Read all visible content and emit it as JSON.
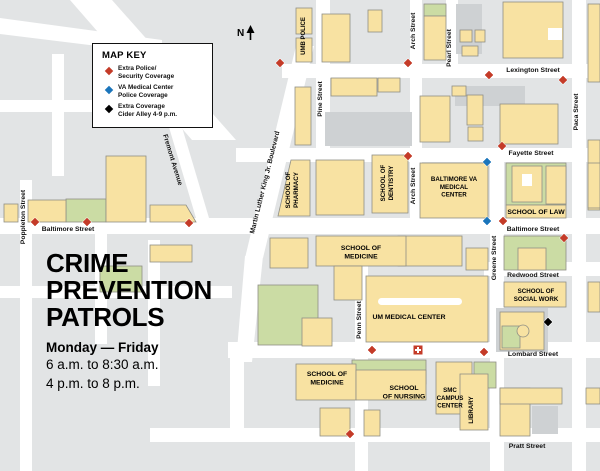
{
  "title_block": {
    "lines": [
      "CRIME",
      "PREVENTION",
      "PATROLS"
    ],
    "schedule_bold": "Monday — Friday",
    "schedule_lines": [
      "6 a.m. to 8:30 a.m.",
      "4 p.m. to 8 p.m."
    ]
  },
  "north_indicator": {
    "label": "N"
  },
  "map_key": {
    "title": "MAP KEY",
    "items": [
      {
        "marker": "red-diamond",
        "color": "#c43b28",
        "lines": [
          "Extra Police/",
          "Security Coverage"
        ]
      },
      {
        "marker": "blue-diamond",
        "color": "#1b75bb",
        "lines": [
          "VA Medical Center",
          "Police Coverage"
        ]
      },
      {
        "marker": "black-diamond",
        "color": "#000000",
        "lines": [
          "Extra Coverage",
          "Cider Alley 4-9 p.m."
        ]
      }
    ]
  },
  "street_labels": [
    {
      "name": "Lexington Street",
      "x": 533,
      "y": 72,
      "rotate": 0
    },
    {
      "name": "Fayette Street",
      "x": 531,
      "y": 155,
      "rotate": 0
    },
    {
      "name": "Baltimore Street",
      "x": 68,
      "y": 231,
      "rotate": 0
    },
    {
      "name": "Baltimore Street",
      "x": 533,
      "y": 231,
      "rotate": 0
    },
    {
      "name": "Redwood Street",
      "x": 533,
      "y": 277,
      "rotate": 0
    },
    {
      "name": "Lombard Street",
      "x": 533,
      "y": 356,
      "rotate": 0
    },
    {
      "name": "Pratt Street",
      "x": 527,
      "y": 448,
      "rotate": 0
    },
    {
      "name": "Poppleton Street",
      "x": 25,
      "y": 217,
      "rotate": -90
    },
    {
      "name": "Pine Street",
      "x": 322,
      "y": 99,
      "rotate": -90
    },
    {
      "name": "Arch Street",
      "x": 415,
      "y": 31,
      "rotate": -90
    },
    {
      "name": "Pearl Street",
      "x": 451,
      "y": 48,
      "rotate": -90
    },
    {
      "name": "Paca Street",
      "x": 578,
      "y": 112,
      "rotate": -90
    },
    {
      "name": "Arch Street",
      "x": 415,
      "y": 186,
      "rotate": -90
    },
    {
      "name": "Greene Street",
      "x": 496,
      "y": 258,
      "rotate": -90
    },
    {
      "name": "Penn Street",
      "x": 361,
      "y": 320,
      "rotate": -90
    },
    {
      "name": "Martin Luther King Jr. Boulevard",
      "x": 254,
      "y": 234,
      "rotate": -76,
      "anchor": "start"
    },
    {
      "name": "Fremont Avenue",
      "x": 163,
      "y": 135,
      "rotate": 73,
      "anchor": "start"
    }
  ],
  "building_labels": [
    {
      "lines": [
        "UMB POLICE"
      ],
      "x": 305,
      "y": 36,
      "rotate": -90,
      "size": 6
    },
    {
      "lines": [
        "SCHOOL OF",
        "PHARMACY"
      ],
      "x": 290,
      "y": 190,
      "rotate": -90,
      "size": 6.2
    },
    {
      "lines": [
        "SCHOOL OF",
        "DENTISTRY"
      ],
      "x": 385,
      "y": 183,
      "rotate": -90,
      "size": 6.2
    },
    {
      "lines": [
        "BALTIMORE VA",
        "MEDICAL",
        "CENTER"
      ],
      "x": 454,
      "y": 181,
      "rotate": 0,
      "size": 6.2
    },
    {
      "lines": [
        "SCHOOL OF LAW"
      ],
      "x": 536,
      "y": 214,
      "rotate": 0,
      "size": 6.8
    },
    {
      "lines": [
        "SCHOOL OF",
        "MEDICINE"
      ],
      "x": 361,
      "y": 250,
      "rotate": 0,
      "size": 6.8
    },
    {
      "lines": [
        "UM MEDICAL CENTER"
      ],
      "x": 409,
      "y": 319,
      "rotate": 0,
      "size": 6.8
    },
    {
      "lines": [
        "SCHOOL OF",
        "SOCIAL WORK"
      ],
      "x": 536,
      "y": 293,
      "rotate": 0,
      "size": 6.2
    },
    {
      "lines": [
        "SCHOOL OF",
        "MEDICINE"
      ],
      "x": 327,
      "y": 376,
      "rotate": 0,
      "size": 6.8
    },
    {
      "lines": [
        "SCHOOL",
        "OF NURSING"
      ],
      "x": 404,
      "y": 390,
      "rotate": 0,
      "size": 6.8
    },
    {
      "lines": [
        "SMC",
        "CAMPUS",
        "CENTER"
      ],
      "x": 450,
      "y": 392,
      "rotate": 0,
      "size": 6.2
    },
    {
      "lines": [
        "LIBRARY"
      ],
      "x": 473,
      "y": 410,
      "rotate": -90,
      "size": 6.2
    }
  ],
  "markers": {
    "red": [
      [
        280,
        63
      ],
      [
        408,
        63
      ],
      [
        489,
        75
      ],
      [
        563,
        80
      ],
      [
        408,
        156
      ],
      [
        502,
        146
      ],
      [
        35,
        222
      ],
      [
        87,
        222
      ],
      [
        189,
        223
      ],
      [
        503,
        221
      ],
      [
        564,
        238
      ],
      [
        372,
        350
      ],
      [
        484,
        352
      ],
      [
        350,
        434
      ]
    ],
    "blue": [
      [
        487,
        162
      ],
      [
        487,
        221
      ]
    ],
    "black": [
      [
        548,
        322
      ]
    ],
    "hospital": [
      [
        418,
        350
      ]
    ]
  },
  "colors": {
    "background": "#e2e4e5",
    "street": "#ffffff",
    "building": "#f8e2a2",
    "building_stroke": "#8f8f85",
    "gray_building": "#ced1d3",
    "green_space": "#cbdca4",
    "red_marker": "#c43b28",
    "blue_marker": "#1b75bb",
    "black_marker": "#000000",
    "text": "#111111"
  }
}
